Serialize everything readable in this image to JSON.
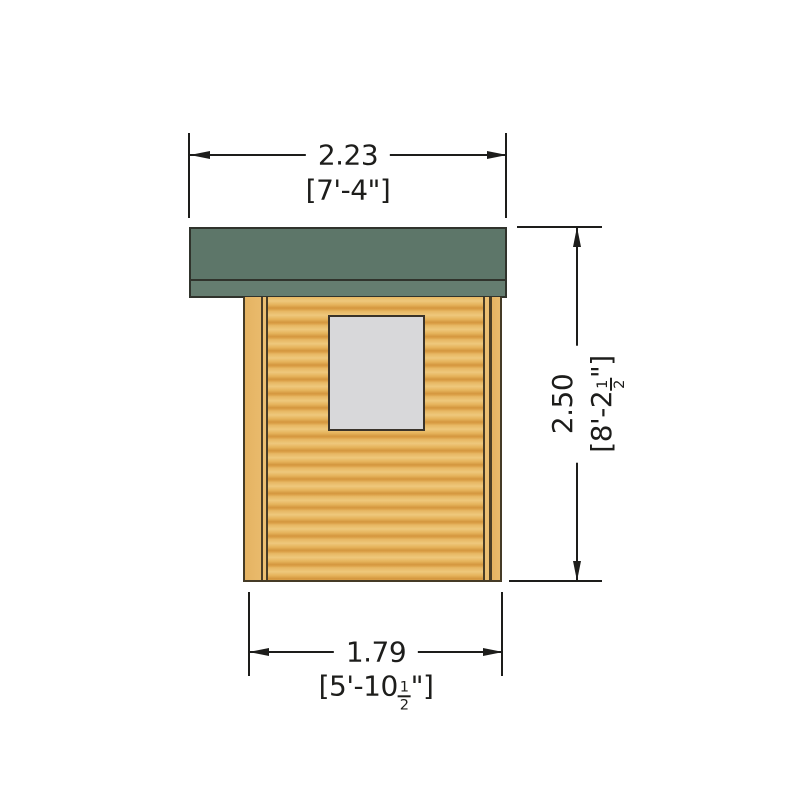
{
  "drawing": {
    "dimensions": {
      "top_width": {
        "metric_m": "2.23",
        "imperial": "[7'-4\"]"
      },
      "right_height": {
        "metric_m": "2.50",
        "imperial_prefix": "[8'-2",
        "fraction_numerator": "1",
        "fraction_denominator": "2",
        "imperial_suffix": "\"]"
      },
      "bottom_width": {
        "metric_m": "1.79",
        "imperial_prefix": "[5'-10",
        "fraction_numerator": "1",
        "fraction_denominator": "2",
        "imperial_suffix": "\"]"
      }
    },
    "colors": {
      "roof": "#5d7669",
      "roof_fascia": "#657d70",
      "wall_log_light": "#eec87c",
      "wall_log_dark": "#d4973f",
      "corner_post": "#e5b362",
      "window_glass": "#d8d8da",
      "outline": "#453b26",
      "dimension_line": "#1d1d1b",
      "background": "#ffffff"
    }
  }
}
